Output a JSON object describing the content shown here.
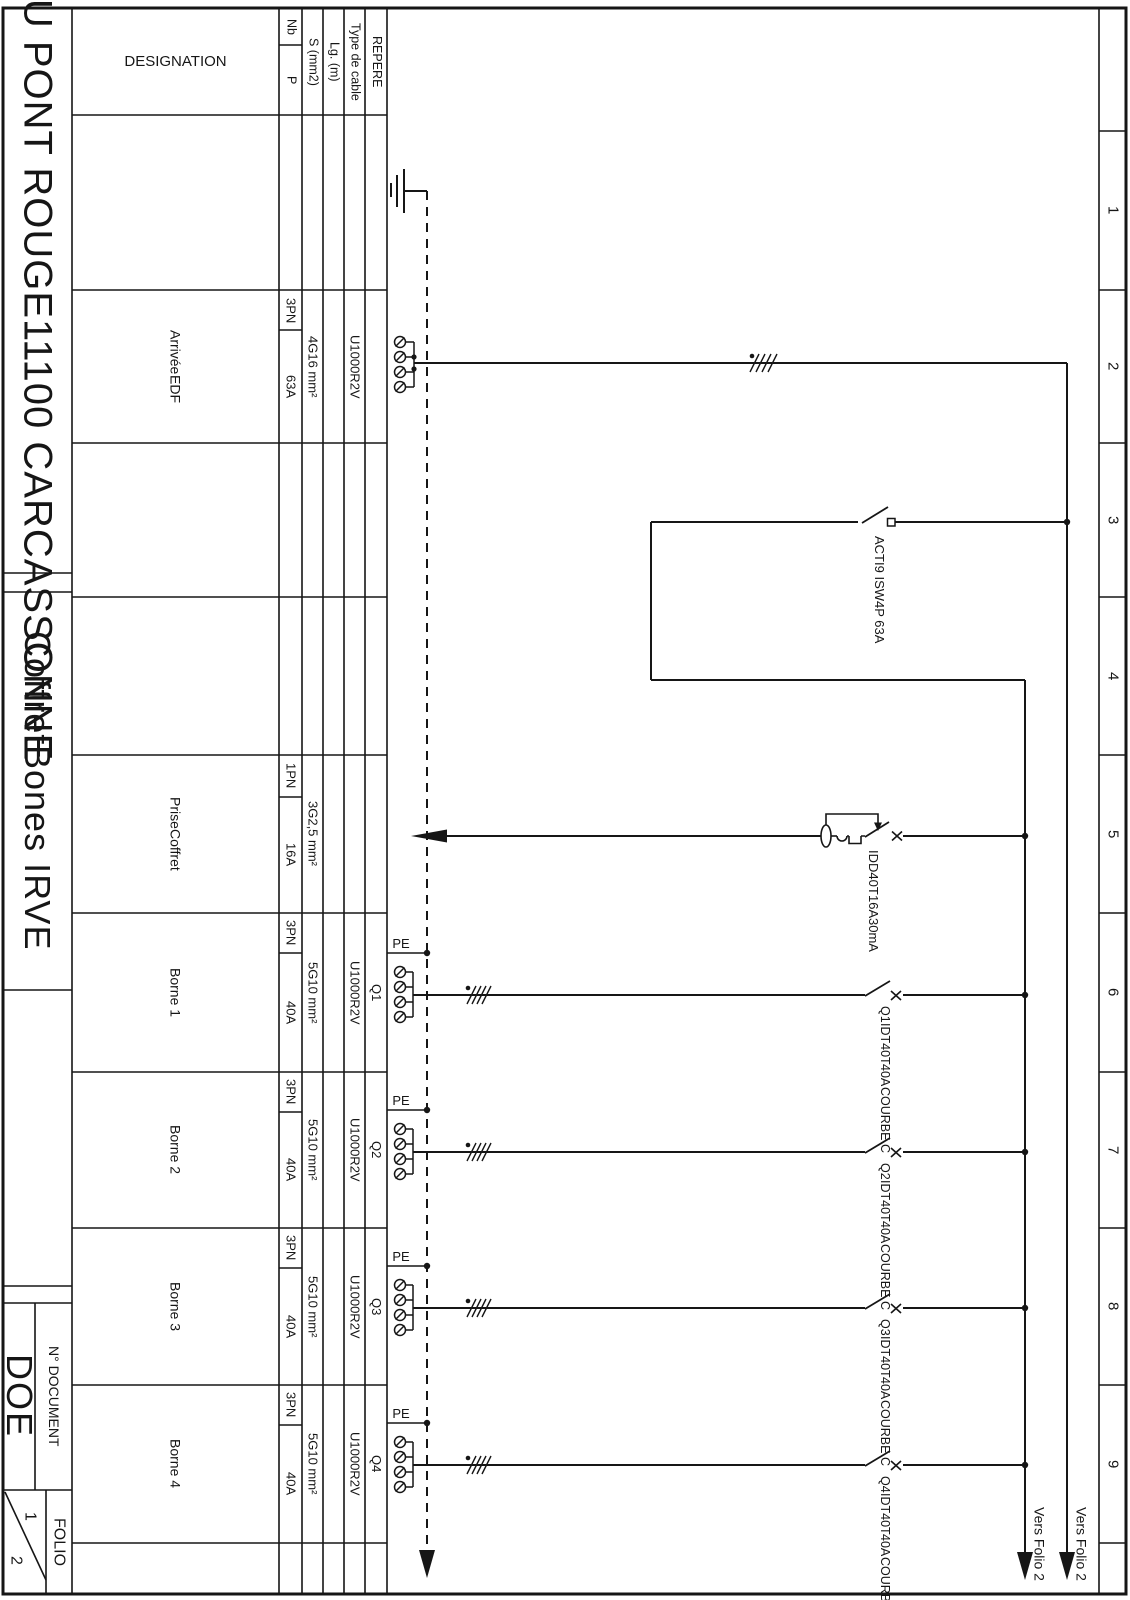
{
  "colors": {
    "ink": "#161616",
    "paper": "#ffffff"
  },
  "title_block": {
    "project": {
      "line1": "HOTEL DU PONT ROUGE",
      "line2": "11100 CARCASSONNE"
    },
    "cabinet": {
      "line1": "Coffret",
      "line2": "Bones IRVE"
    },
    "document": {
      "label": "N° DOCUMENT",
      "value": "DOE"
    },
    "folio": {
      "label": "FOLIO",
      "current": "1",
      "total": "2"
    }
  },
  "table": {
    "headers": {
      "designation": "DESIGNATION",
      "nb": "Nb",
      "p": "P",
      "s": "S (mm2)",
      "lg": "Lg. (m)",
      "type": "Type de cable",
      "repere": "REPERE"
    },
    "rows": [
      {
        "designation_line1": "Arrivée",
        "designation_line2": "EDF",
        "nb": "3PN",
        "p": "63A",
        "s": "4G16 mm²",
        "lg": "",
        "type": "U1000R2V",
        "repere": ""
      },
      {
        "designation_line1": "Prise",
        "designation_line2": "Coffret",
        "nb": "1PN",
        "p": "16A",
        "s": "3G2,5 mm²",
        "lg": "",
        "type": "",
        "repere": ""
      },
      {
        "designation": "Borne 1",
        "nb": "3PN",
        "p": "40A",
        "s": "5G10 mm²",
        "lg": "",
        "type": "U1000R2V",
        "repere": "Q1"
      },
      {
        "designation": "Borne 2",
        "nb": "3PN",
        "p": "40A",
        "s": "5G10 mm²",
        "lg": "",
        "type": "U1000R2V",
        "repere": "Q2"
      },
      {
        "designation": "Borne 3",
        "nb": "3PN",
        "p": "40A",
        "s": "5G10 mm²",
        "lg": "",
        "type": "U1000R2V",
        "repere": "Q3"
      },
      {
        "designation": "Borne 4",
        "nb": "3PN",
        "p": "40A",
        "s": "5G10 mm²",
        "lg": "",
        "type": "U1000R2V",
        "repere": "Q4"
      }
    ]
  },
  "schematic": {
    "pe_label": "PE",
    "main_switch": {
      "line1": "ACTI9 ISW",
      "line2": "4P 63A"
    },
    "rcd": {
      "line1": "IDD40T",
      "line2": "16A",
      "line3": "30mA"
    },
    "branch_breakers": [
      {
        "name": "Q1",
        "device": "IDT40T",
        "rating": "40A",
        "curve": "COURBE C"
      },
      {
        "name": "Q2",
        "device": "IDT40T",
        "rating": "40A",
        "curve": "COURBE C"
      },
      {
        "name": "Q3",
        "device": "IDT40T",
        "rating": "40A",
        "curve": "COURBE C"
      },
      {
        "name": "Q4",
        "device": "IDT40T",
        "rating": "40A",
        "curve": "COURBE C"
      }
    ],
    "outgoing": [
      {
        "label": "Vers Folio 2"
      },
      {
        "label": "Vers Folio 2"
      }
    ],
    "grid_numbers": [
      "1",
      "2",
      "3",
      "4",
      "5",
      "6",
      "7",
      "8",
      "9"
    ]
  }
}
